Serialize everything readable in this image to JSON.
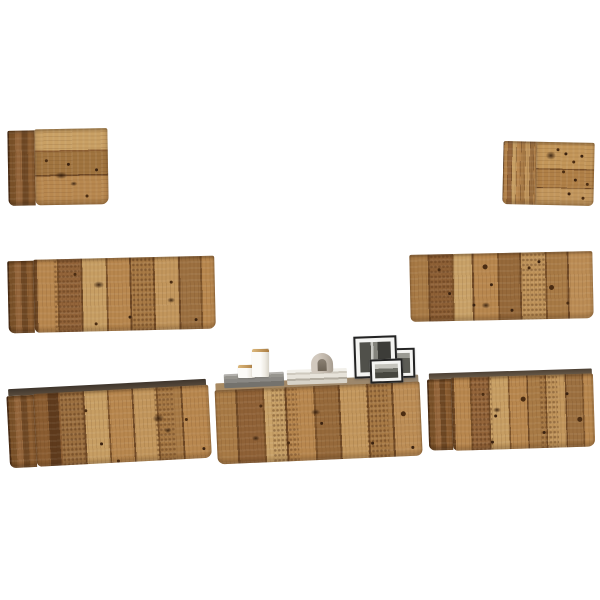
{
  "scene": {
    "type": "product-photo",
    "subject": "Seven-piece wall-mounted TV cabinet set in rustic old-wood finish with decor styling",
    "background_color": "#ffffff"
  },
  "objects": {
    "cabinets": [
      {
        "name": "wall-cabinet-top-left",
        "finish": "old wood"
      },
      {
        "name": "wall-cabinet-top-right",
        "finish": "old wood"
      },
      {
        "name": "wall-cabinet-mid-left",
        "finish": "old wood"
      },
      {
        "name": "wall-cabinet-mid-right",
        "finish": "old wood"
      },
      {
        "name": "tv-cabinet-bottom-left",
        "finish": "old wood"
      },
      {
        "name": "tv-cabinet-bottom-center",
        "finish": "old wood"
      },
      {
        "name": "tv-cabinet-bottom-right",
        "finish": "old wood"
      }
    ],
    "decor": [
      {
        "name": "magazine-stack-grey"
      },
      {
        "name": "pillar-candle-short",
        "accent": "gold rim"
      },
      {
        "name": "pillar-candle-tall",
        "accent": "gold rim"
      },
      {
        "name": "book-stack-cream"
      },
      {
        "name": "arch-ornament"
      },
      {
        "name": "picture-frame-large",
        "photo": "black-and-white buildings"
      },
      {
        "name": "picture-frame-landscape",
        "photo": "black-and-white cityscape"
      },
      {
        "name": "picture-frame-portrait",
        "photo": "black-and-white"
      }
    ]
  },
  "palette": {
    "wood_light": "#c79e63",
    "wood_mid": "#b8874e",
    "wood_dark": "#8a5c30",
    "wood_streak": "#5e3a1c",
    "knot": "#4a2c12",
    "top_face_dark": "#46false3b32",
    "top_face_tan": "#a98a62",
    "candle_white": "#f3f1ec",
    "candle_rim_gold": "#c09355",
    "stack_grey": "#8f8f8d",
    "book_cream": "#eeece6",
    "arch_beige": "#c7bdb2",
    "frame_black": "#232323",
    "frame_mat": "#f4f4f2",
    "photo_grey": "#55554f"
  }
}
